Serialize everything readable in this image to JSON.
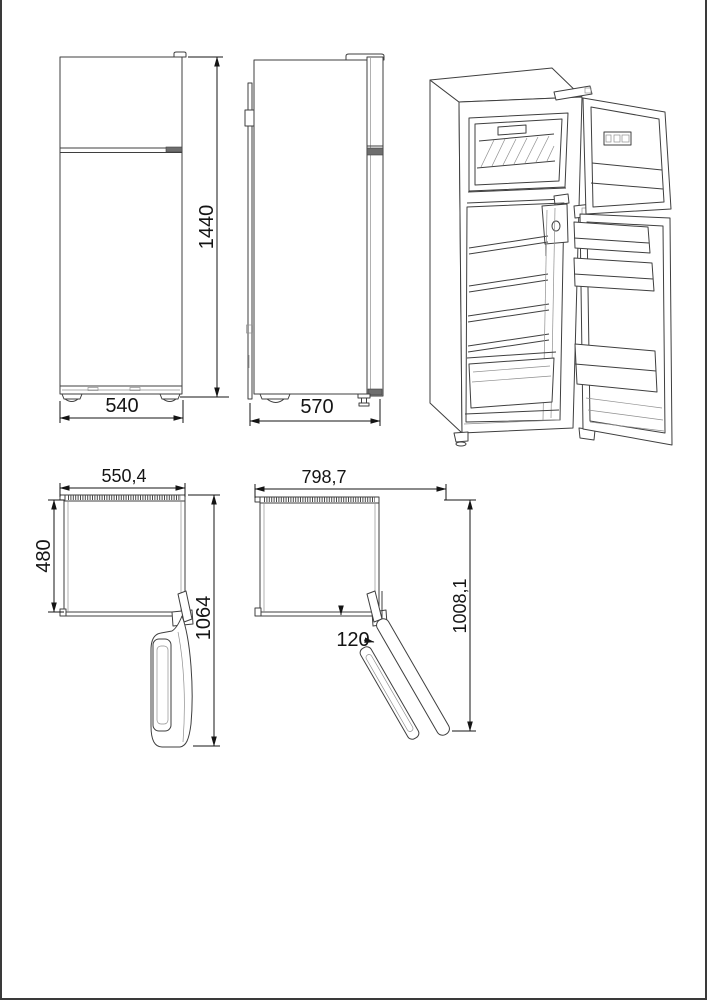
{
  "colors": {
    "background": "#ffffff",
    "line": "#3f3f3f",
    "dimension": "#141414",
    "dark_fill": "#6e6e6e"
  },
  "drawing": {
    "front_view": {
      "height_mm": "1440",
      "width_mm": "540"
    },
    "side_view": {
      "depth_mm": "570"
    },
    "top_view_90": {
      "width_mm": "550,4",
      "cabinet_depth_mm": "480",
      "total_depth_mm": "1064"
    },
    "top_view_120": {
      "swing_width_mm": "798,7",
      "total_depth_mm": "1008,1",
      "door_angle": "120"
    }
  }
}
